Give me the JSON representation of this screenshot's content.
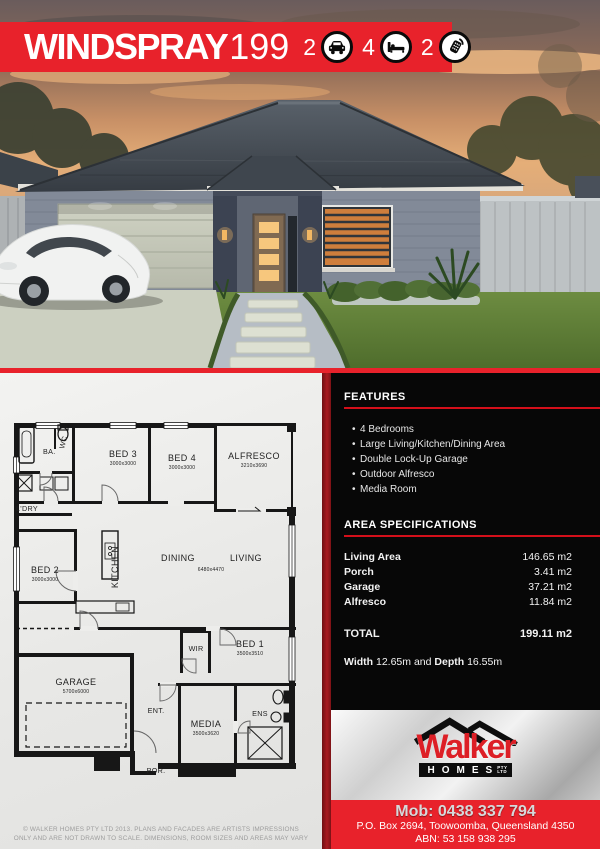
{
  "banner": {
    "title_main": "WINDSPRAY",
    "title_number": "199",
    "stats": [
      {
        "value": "2",
        "icon": "car"
      },
      {
        "value": "4",
        "icon": "bed"
      },
      {
        "value": "2",
        "icon": "shower"
      }
    ]
  },
  "features": {
    "heading": "FEATURES",
    "bullet": "•",
    "items": [
      "4 Bedrooms",
      "Large Living/Kitchen/Dining Area",
      "Double Lock-Up Garage",
      "Outdoor Alfresco",
      "Media Room"
    ]
  },
  "area_specifications": {
    "heading": "AREA SPECIFICATIONS",
    "rows": [
      {
        "label": "Living Area",
        "value": "146.65 m2"
      },
      {
        "label": "Porch",
        "value": "3.41 m2"
      },
      {
        "label": "Garage",
        "value": "37.21 m2"
      },
      {
        "label": "Alfresco",
        "value": "11.84 m2"
      }
    ],
    "total": {
      "label": "TOTAL",
      "value": "199.11 m2"
    },
    "dimensions": {
      "width_label": "Width",
      "width_value": "12.65m",
      "joiner": "and",
      "depth_label": "Depth",
      "depth_value": "16.55m"
    }
  },
  "floorplan": {
    "ba": "BA.",
    "wc": "WC",
    "ldry": "L'DRY",
    "kitchen": "KITCHEN",
    "dining": "DINING",
    "living": "LIVING",
    "dining_living_dims": "6480x4470",
    "bed3": {
      "name": "BED 3",
      "dims": "3000x3000"
    },
    "bed4": {
      "name": "BED 4",
      "dims": "3000x3000"
    },
    "alfresco": {
      "name": "ALFRESCO",
      "dims": "3210x3690"
    },
    "bed2": {
      "name": "BED 2",
      "dims": "3000x3000"
    },
    "wir": "WIR",
    "bed1": {
      "name": "BED 1",
      "dims": "3500x3510"
    },
    "garage": {
      "name": "GARAGE",
      "dims": "5700x6000"
    },
    "ent": "ENT.",
    "media": {
      "name": "MEDIA",
      "dims": "3500x3620"
    },
    "ens": "ENS",
    "por": "POR."
  },
  "brand": {
    "name": "Walker",
    "homes": "HOMES",
    "pty": "PTY",
    "ltd": "LTD",
    "mob_label": "Mob:",
    "mob_number": "0438 337 794",
    "address": "P.O. Box 2694, Toowoomba, Queensland 4350",
    "abn": "ABN: 53 158 938 295"
  },
  "disclaimer": {
    "line1": "© WALKER HOMES PTY LTD 2013.  PLANS AND FACADES ARE ARTISTS IMPRESSIONS",
    "line2": "ONLY AND ARE NOT DRAWN TO SCALE.  DIMENSIONS, ROOM SIZES AND AREAS MAY VARY"
  },
  "colors": {
    "brand_red": "#e8222b",
    "panel_black": "#070707",
    "dark_red_strip": "#8d161b",
    "underline_red": "#d40f1a"
  }
}
